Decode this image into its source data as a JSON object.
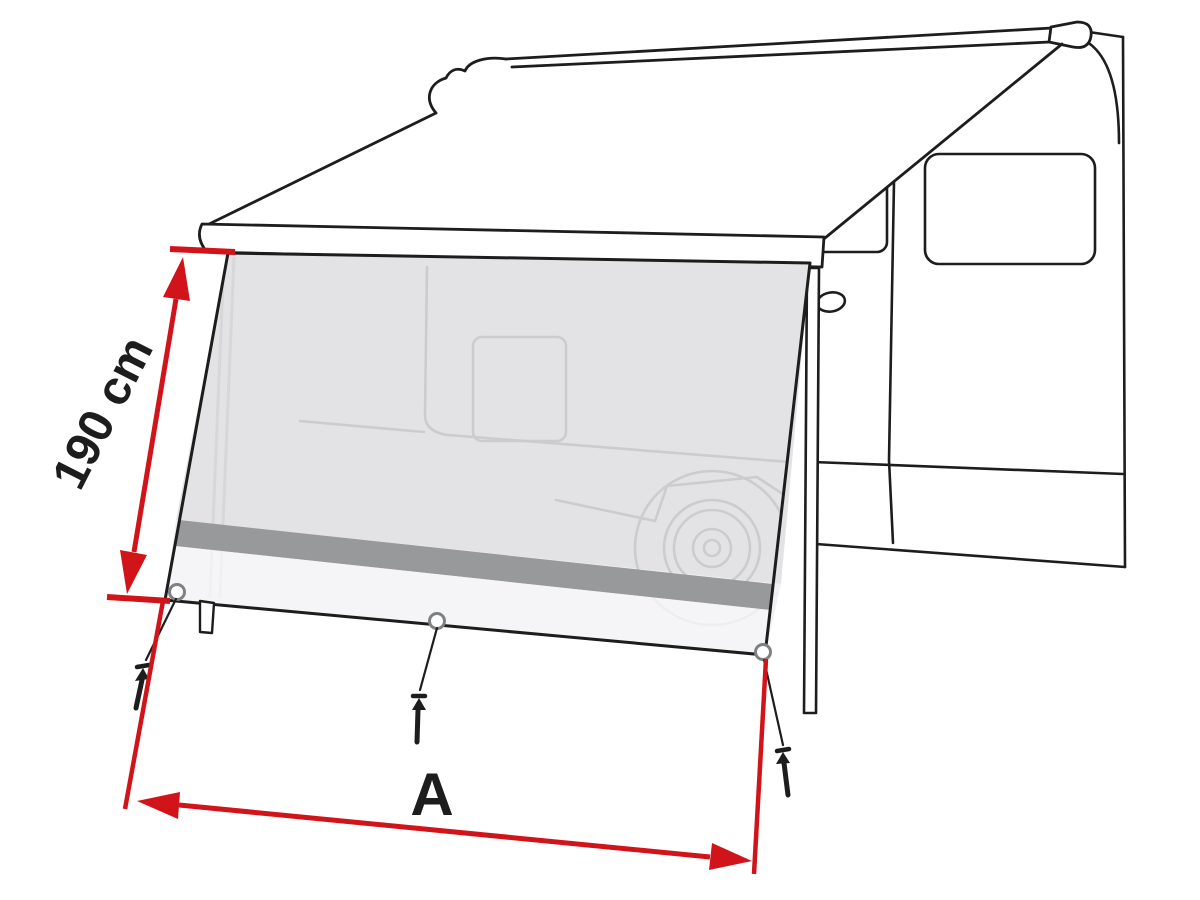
{
  "figure": {
    "type": "technical-product-illustration",
    "subject": "awning-front-side-panel-mounted-on-camper-van",
    "dimension_labels": {
      "height": "190 cm",
      "width": "A"
    }
  },
  "colors": {
    "dimension_red": "#d0141a",
    "outline_black": "#1d1d1d",
    "panel_mesh_gray": "#e3e3e5",
    "panel_stripe_gray": "#98999b",
    "panel_skirt_light": "#f5f5f6",
    "ghost_line_gray": "#cbccce"
  }
}
